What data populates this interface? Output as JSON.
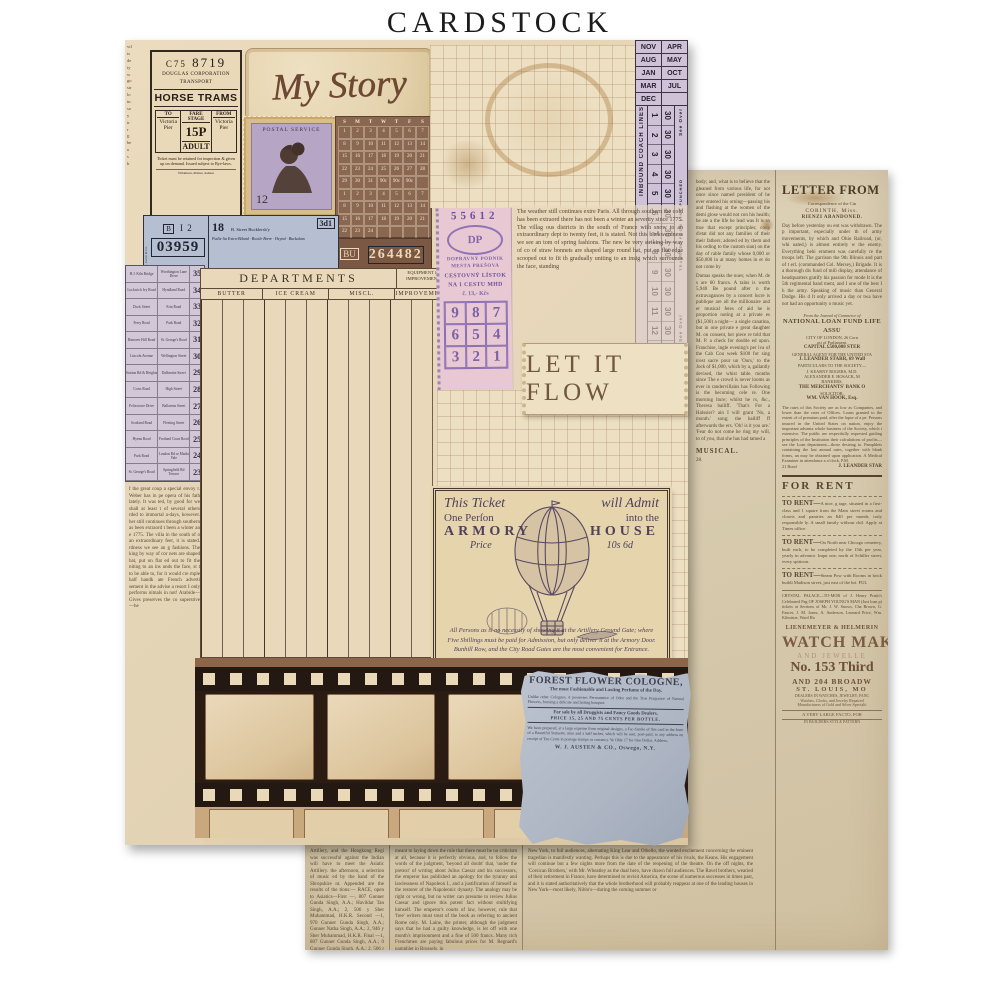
{
  "page": {
    "title": "CARDSTOCK"
  },
  "palette": {
    "cream": "#ecdfc2",
    "newsprint": "#d8cdb3",
    "lavender": "#cfc2d8",
    "pink": "#e7c8d3",
    "blue_ticket": "#b5bfd1",
    "brown": "#7b5843",
    "blue_gray": "#aeb6c4",
    "ink_brown": "#584631",
    "ink_purple": "#6b4f9e",
    "ink_violet": "#4f415c"
  },
  "front": {
    "left_top_fragments": "vil\nis\nde\nty\nw\ngo\nstr\nlo\nin\nso\ny\nir\nr\nll\nbe\no\ns\nb",
    "horse_ticket": {
      "serial_prefix": "C75",
      "serial": "8719",
      "org1": "DOUGLAS CORPORATION",
      "org2": "TRANSPORT",
      "title": "HORSE TRAMS",
      "to_label": "TO",
      "fare_label": "FARE STAGE",
      "from_label": "FROM",
      "to": "Victoria Pier",
      "fare": "15P",
      "fare_class": "ADULT",
      "from": "Victoria Pier",
      "fine_print": "Ticket must be retained for inspection & given up on demand. Issued subject to Bye-laws.",
      "printer": "Wilamson, Printer, Ashton"
    },
    "my_story": {
      "text": "My Story"
    },
    "stamp": {
      "header": "POSTAL SERVICE",
      "value": "12"
    },
    "calendar": {
      "weekdays": [
        "S",
        "M",
        "T",
        "W",
        "T",
        "F",
        "S"
      ],
      "rows": [
        [
          "1",
          "2",
          "3",
          "4",
          "5",
          "6",
          "7"
        ],
        [
          "8",
          "9",
          "10",
          "11",
          "12",
          "13",
          "14"
        ],
        [
          "15",
          "16",
          "17",
          "18",
          "19",
          "20",
          "21"
        ],
        [
          "22",
          "23",
          "24",
          "25",
          "26",
          "27",
          "28"
        ],
        [
          "29",
          "30",
          "31",
          "90c",
          "90c",
          "90c",
          ""
        ],
        [
          "1",
          "2",
          "3",
          "4",
          "5",
          "6",
          "7"
        ],
        [
          "8",
          "9",
          "10",
          "11",
          "12",
          "13",
          "14"
        ],
        [
          "15",
          "16",
          "17",
          "18",
          "19",
          "20",
          "21"
        ],
        [
          "22",
          "23",
          "24",
          "",
          "",
          "",
          ""
        ]
      ]
    },
    "brown_ticket": {
      "prefix": "BU",
      "number": "264482"
    },
    "months_ticket": {
      "pairs": [
        [
          "NOV",
          "APR"
        ],
        [
          "AUG",
          "MAY"
        ],
        [
          "JAN",
          "OCT"
        ],
        [
          "MAR",
          "JUL"
        ],
        [
          "DEC",
          ""
        ]
      ],
      "side_left": "INBOUND COACH LINES",
      "numbers": [
        "1",
        "2",
        "3",
        "4",
        "5",
        "6",
        "7",
        "8",
        "9",
        "10",
        "11",
        "12"
      ],
      "thirties": [
        "30",
        "30",
        "30",
        "30",
        "30",
        "30",
        "30",
        "30",
        "30",
        "30",
        "30",
        "30"
      ],
      "see_over_top": "See Over",
      "transfer": "TRANSFER FROM LINE PUNCHED",
      "see_over_bottom": "See Over"
    },
    "blue_ticket": {
      "edge": "A. Germ & Co.",
      "crest": "B",
      "code": "I 2",
      "number": "03959",
      "route": "18",
      "dest_top": "B. Street Bucklersb'y",
      "dest_lines": "Putlis-lia Extra-Biland · Bootle Brere · Heytal · Buckalam",
      "fare": "3d1"
    },
    "fare_list": [
      [
        "H.J. Kiln Bridge",
        "Worthington Lane Drive",
        "35"
      ],
      [
        "Lockwich Ivy Road",
        "Hyndland Road",
        "34"
      ],
      [
        "Dock Street",
        "Erin Road",
        "33"
      ],
      [
        "Ferry Road",
        "Park Road",
        "32"
      ],
      [
        "Hanover Hill Road",
        "St. George's Road",
        "31"
      ],
      [
        "Lincoln Avenue",
        "Wellington Street",
        "30"
      ],
      [
        "Station Rd & Heights",
        "Dalbeattie Street",
        "29"
      ],
      [
        "Cross Road",
        "High Street",
        "28"
      ],
      [
        "Felixstowe Drive",
        "Ballarena Street",
        "27"
      ],
      [
        "Scotland Road",
        "Fleeting Street",
        "26"
      ],
      [
        "Hyena Road",
        "Portland Court Road",
        "25"
      ],
      [
        "Park Road",
        "Loudon Rd or Maida Vale",
        "24"
      ],
      [
        "St. George's Road",
        "Springfield Rd Terrace",
        "23"
      ]
    ],
    "left_col_text": "f the great coup a special envoy r. Weber has in pe opera of his fath lately. It was ted, by good for we shall at least t of several others rded to immortal a-days, however. her still continues through southern as been extraord t been a winter an e 1775. The villa in the south of o an extraordinary feet, it is stated. rdness we see an g fashions. The king by way of cor nets are shaped bat, put on flat ed out to fit the niting to an ins unds the face, st t to be able to, for it would cre mple half handk ate French adverti sement in the advise a resort I only performs nimals in not! Arabide—Gives preserves the co superstive—he",
    "ledger": {
      "title": "DEPARTMENTS",
      "equipment_head": "EQUIPMENT & IMPROVEMENT",
      "columns": [
        "BUTTER",
        "ICE CREAM",
        "MISCL.",
        "IMPROVEMENT"
      ]
    },
    "pink_ticket": {
      "serial": "55612",
      "logo": "DP",
      "org1": "DOPRAVNÝ PODNIK",
      "org2": "MESTA PREŠOVA",
      "line1": "CESTOVNÝ LÍSTOK",
      "line2": "NA 1 CESTU MHD",
      "price": "č. 13,- Kčs",
      "grid": [
        [
          "9",
          "8",
          "7"
        ],
        [
          "6",
          "5",
          "4"
        ],
        [
          "3",
          "2",
          "1"
        ]
      ]
    },
    "weather_text": "The weather still continues extre Paris. All through southern the cold has been extraord there has not been a winter an severity since 1775. The villag ous districts in the south of France with snow to an extraordinary dept to twenty feet, it is stated. Not this backwardness we see an tom of spring fashions. The new be very striking by way of co of straw bonnets are shaped large round hat, put on flat edge scooped out to fit th gradually uniting to an insig which surrounds the face, standing",
    "let_it_flow": "LET IT FLOW",
    "balloon_ticket": {
      "l1a": "This Ticket",
      "l1b": "will Admit",
      "l2a": "One Perſon",
      "l2b": "into the",
      "l3a": "ARMORY",
      "l3b": "HOUSE",
      "l4a": "Price",
      "l4b": "10s 6d",
      "body": "All Persons as is no necessity of showing it at the Artillery Ground Gate; where Five Shillings must be paid for Admission, but only deliver it at the Armory Door. Bunhill Row, and the City Road Gates are the most convenient for Entrance."
    },
    "cologne": {
      "title": "FOREST FLOWER COLOGNE,",
      "sub": "The most Fashionable and Lasting Perfume of the Day.",
      "p1": "Unlike other Colognes, it possesses Permanence of Odor and the True Fragrance of Natural Flowers, forming a delicate and lasting bouquet.",
      "sale": "For sale by all Druggists and Fancy Goods Dealers.",
      "price": "PRICE 15, 25 AND 75 CENTS PER BOTTLE.",
      "p2": "We have prepared, at a large expense from original designs, a Fac-Simile of this card in the form of a Beautiful Statuette, nine and a half inches, which will be sent, post-paid, to any address on receipt of Ten Cents in postage stamps or currency. Ye Olde 17 for One Dollar. Address,",
      "sig": "W. J. AUSTEN & CO., Oswego, N.Y."
    }
  },
  "back": {
    "col_a_text1": "body; and, what is to believe that the gleaned from various life, for not once since named president of he ever entered his orning—passing his and flashing at the women of the demi glose would not con his health; he ate a the life he lead was It is so true that except principles; coup d'etat did not any families of their their fathers; adored ed by them and his ording to the custom sian) on the day of rable family whose 0,000 or $50,000 in at many homes in er do not come by",
    "col_a_text2": "Dumas speaks the nues; when M. de s are 60 francs. A tains is worth 5,940 Be pound after n the extravagances by a concert lucre is publique are all the millionaire and er musical fetes of aid he is proportion noting at a private es ($1,500) a night— a single canatina, but in one private e great daughter M. on consent, her piece re told that M. P. a check for double ed upon. Franchise, ingle evening's per iva of the Cab Cou week $100 for sing n'est sacre pour un 'Ours,' to the Jock of $1,000, which by a, gallantly devised, the whist table. months since The e crowd is never looms as ever in randervillains has Following is the becoming cele re. One morning lture; whilst he rs, &c., Theresa bailiff. 'That's For a Halssier? ain I will grant 'No, a month.' song; the bailiff ff afterwards the ers. 'Oh! is it you are.' 'Fear do not come he ring my will, to of you, that she has had tamed a",
    "col_a_musical": "MUSICAL.",
    "col_a_tail": "28.",
    "letter": {
      "headline": "LETTER FROM COR",
      "sub": "Correspondence of the Cin",
      "dateline": "CORINTH, Miss.",
      "subhead": "RIENZI ABANDONED.",
      "body": "Day before yesterday ou ent was withdrawn. The p important, especially under th of army movements, by which and Ohio Railroad, (or, whi uated,) is almost entirely w the enemy. Everything behi ernment was carefully re the troops left. The garrison the 9th Illinois and part of t erl. (commanded Col. Mersey,) Brigade. It is a thorough dis fund of mili display, attendance of headquarters gratify his passion for mode It is the 5th regimental band ment, and I one of the best I h the army. Speaking of music than General Dodge. His d It only arrived a day or twa have not had an opportunity o music yet."
    },
    "loan": {
      "intro": "From the Journal of Commerce of",
      "name": "NATIONAL LOAN FUND LIFE ASSU",
      "addr": "CITY OF LONDON, 26 Corn",
      "act": "act of Parliament.",
      "capital": "CAPITAL £500,000 STER",
      "agent_label": "GENERAL AGENT FOR THE UNITED STA",
      "agent": "J. LEANDER STARR, 69 Wall",
      "ref_label": "PARTICULARS TO THE SOCIETY—",
      "ref1": "J. KEARNY ROGERS, M.D.",
      "ref2": "ALEXANDER E. HOSACK, M",
      "bankers_label": "BANKERS,",
      "bankers": "THE MERCHANTS' BANK O",
      "sol_label": "SOLICITOR,",
      "sol": "WM. VAN HOOK, Esq.",
      "body": "The rates of this Society are as low as Companies, and lower than the rates of Offices. Loans granted to the extent of of premium paid, after the lapse of a pe. Persons insured in the United States on nation, enjoy the important advanta whole business of the Society, which i extensive. The public are respectfully requested guiding principles of the Institution their calculations of profits—see the Loan department—those desiring to. Pamphlets containing the last annual rates, together with blank forms, an may be obtained upon application. A Medical Examiner in attendance a o'clock, P.M.",
      "sig_left": "21 Bond",
      "sig": "J. LEANDER STAR"
    },
    "for_rent": {
      "header": "FOR RENT",
      "ads": [
        {
          "lead": "TO RENT—",
          "text": "A nice, g tage, situated in a first-class and 1 square from the Main street rooms and closets and pantries an $40 per month; truly responsible ly. A small family without chil. Apply at Times office."
        },
        {
          "lead": "TO RENT—",
          "text": "On North near Chicago cemetery, built each, to be completed by the 15th per year, yearly in advance. Inqui one, north of Schiller street, every spittoon."
        },
        {
          "lead": "TO RENT—",
          "text": "Steam Pow with Rooms in brick buildi Madison street, just east of the bri. FUL"
        }
      ],
      "crystal": "CRYSTAL PALACE—TO-MOR of J. Henry Prado's Celebrated Pag OF JOSEPH YOUNG'S MAN (Just loan p) tickets at Sections of Mr. J. W. Snows, Cha Brown, G. Faucet, J. M. Jones, A. Anderson, Leonard Price, Wm. Kilmister, Ward Ha"
    },
    "watch": {
      "l1": "LIENEMEYER & HELMERIN",
      "l2": "WATCH MAKE",
      "l3": "AND JEWELLE",
      "l4": "No. 153 Third",
      "l5": "AND 204 BROADW",
      "l6": "ST. LOUIS, MO",
      "l7": "DEALERS IN WATCHES, JEWELRY, FANC",
      "l8": "Watches, Clocks, and Jewelry Repaired",
      "l9": "Manufacturers of Gold and Silver Specialti",
      "l10": "A VERY LARGE FACTO, FOR",
      "l11": "IN BUILDERS STYLE PATTERN"
    },
    "bottom": {
      "col1": "Artillery, and the Hongkong Regi was successful against the Indian will have to meet the Asiatic Artillery. the afternoon, a selection of music ed by the band of the Shropshire nt. Appended are the results of the tions:— RACE, open to Asiatics—First —, 807 Gunner Gunda Singh, A.A.; Havildar Tan Singh, A.A.; 2, 506 y Sher Muhammad, H.K.R. Second —1, 970 Gunner Gunda Singh, A.A.; Gunner Natha Singh, A.A.; 2, 946 y Sher Muhammad, H.K.R. Final —1, 807 Gunner Gunda Singh, A.A.; 0 Gunner Gunda Singh, A.A.; 2, 506 r Sher Muhammad, H.K.R.",
      "col2": "meant to laying down the rule that there must be no criticism at all, because it is perfectly obvious, and, to follow the words of the judgment, 'beyond all doubt' that, 'under the pretext' of writing about Julius Caesar and his successors, the emperor has published an apology for the tyranny and lawlessness of Napoleon I., and a justification of himself as the restorer of the Napoleonic dynasty. The analogy may be right or wrong, but no writer can presume to review Julius Caesar and ignore this potent fact without stultifying himself. The emperor's courts of law, however, rule that 'free' writers must treat of the book as referring to ancient Rome only. M. Laine, the printer, although the judgment says that he had a guilty knowledge, is let off with one month's imprisonment and a fine of 500 francs. Many rich Frenchmen are paying fabulous prices for M. Regnard's pamphlet in Brussels, in",
      "col3": "New York, to full audiences, alternating King Lear and Othello, the wonted excitement concerning the eminent tragedian is manifestly wanting. Perhaps this is due to the appearance of his rivals, the Keans. His engagement will continue but a few nights more from the date of the reopening of the theatre. On the off nights, the 'Corsican Brothers,' with Mr. Wheatley as the dual hero, have drawn full audiences. The Ravel brothers, wearied of their retirement in France, have determined to revisit America, the scene of numerous successes in times past, and it is stated authoritatively that the whole brotherhood will probably reappear at one of the leading houses in New York—most likely, Niblo's—during the coming summer or"
    }
  }
}
